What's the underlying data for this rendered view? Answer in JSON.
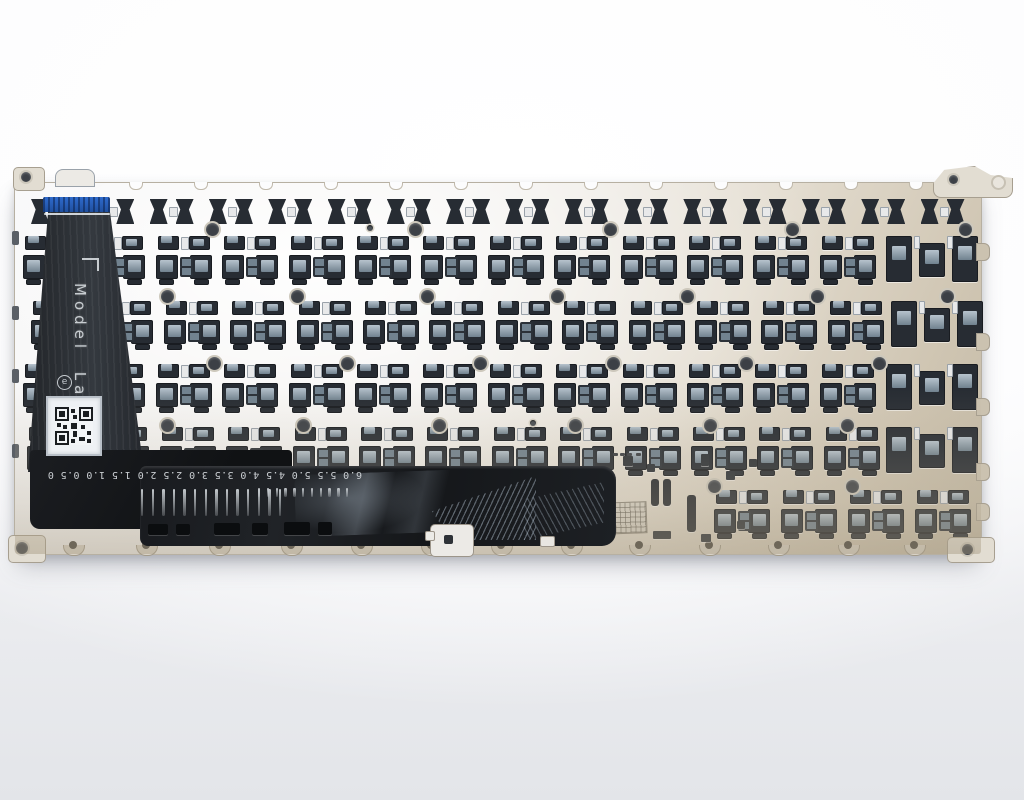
{
  "photo": {
    "subject": "rear side of a laptop keyboard backplate with ribbon cable and flex circuit"
  },
  "ribbon": {
    "model_label": "Model Label",
    "e_mark": "e"
  },
  "flex_ruler": {
    "text": "6.0 5.5 5.0 4.5 4.0 3.5 3.0 2.5 2.0 1.5 1.0 0.5 0",
    "long_ticks": 14,
    "long_tick_start_x": 141,
    "long_tick_pitch": 10.6,
    "long_tick_top": 489,
    "long_tick_height": 27,
    "short_ticks": 11,
    "short_tick_start_x": 258,
    "short_tick_pitch": 8.8,
    "short_tick_top": 488,
    "short_tick_height": 9
  },
  "colors": {
    "hook_dark": "#272c33",
    "hook_mid": "#71828f",
    "hook_light": "#b7c3cd",
    "connector_blue": "#2f6bcd",
    "text_light": "#c8cdd1"
  },
  "plate": {
    "rows": [
      {
        "type": "fn",
        "y": 16,
        "x0": 16,
        "pitch": 59.3,
        "count": 16
      },
      {
        "type": "std",
        "y": 53,
        "x0": 8,
        "pitch": 66.4,
        "count": 13,
        "wide": 871
      },
      {
        "type": "std",
        "y": 118,
        "x0": 16,
        "pitch": 66.4,
        "count": 13,
        "wide": 876
      },
      {
        "type": "std",
        "y": 181,
        "x0": 8,
        "pitch": 66.4,
        "count": 13,
        "wide": 871
      },
      {
        "type": "std",
        "y": 244,
        "x0": 12,
        "pitch": 66.4,
        "count": 13,
        "wide": 871
      },
      {
        "type": "std",
        "y": 307,
        "x0": 699,
        "pitch": 66.9,
        "count": 4
      }
    ],
    "screw_holes": [
      {
        "y": 40,
        "x": [
          191,
          394,
          589,
          771,
          944
        ]
      },
      {
        "y": 107,
        "x": [
          146,
          276,
          406,
          536,
          666,
          796,
          926
        ]
      },
      {
        "y": 174,
        "x": [
          193,
          326,
          459,
          592,
          725,
          858
        ]
      },
      {
        "y": 236,
        "x": [
          146,
          282,
          418,
          554,
          689,
          826
        ]
      },
      {
        "y": 297,
        "x": [
          693,
          831
        ]
      }
    ],
    "small_dots": [
      [
        515,
        237
      ],
      [
        352,
        42
      ]
    ],
    "top_notches_x": [
      114,
      179,
      244,
      309,
      374,
      439,
      504,
      569,
      634,
      699,
      764,
      829,
      894
    ],
    "bottom_dimples_x": [
      48,
      121,
      194,
      266,
      336,
      406,
      476,
      546,
      614,
      684,
      753,
      823,
      889
    ],
    "left_notches_y": [
      48,
      123,
      186,
      261
    ],
    "right_tabs_y": [
      60,
      150,
      215,
      280,
      320
    ],
    "extra_slots": [
      [
        636,
        296,
        8,
        27
      ],
      [
        648,
        296,
        8,
        27
      ],
      [
        672,
        312,
        9,
        37
      ]
    ],
    "extra_squares": [
      [
        608,
        273,
        10,
        10
      ],
      [
        632,
        281,
        8,
        8
      ],
      [
        686,
        271,
        8,
        12
      ],
      [
        711,
        288,
        9,
        9
      ],
      [
        734,
        276,
        8,
        8
      ],
      [
        614,
        338,
        9,
        9
      ],
      [
        638,
        348,
        18,
        8
      ],
      [
        686,
        351,
        10,
        8
      ],
      [
        722,
        338,
        8,
        8
      ]
    ],
    "tiny_dashes": [
      [
        598,
        270
      ],
      [
        605,
        270
      ],
      [
        612,
        270
      ],
      [
        621,
        270
      ]
    ],
    "etch_mark": [
      584,
      319,
      46,
      30
    ],
    "flex_bottom_slots": [
      [
        148,
        524,
        20,
        11
      ],
      [
        176,
        524,
        14,
        11
      ],
      [
        214,
        523,
        26,
        12
      ],
      [
        252,
        523,
        16,
        12
      ],
      [
        284,
        522,
        26,
        13
      ],
      [
        318,
        522,
        14,
        13
      ]
    ]
  }
}
